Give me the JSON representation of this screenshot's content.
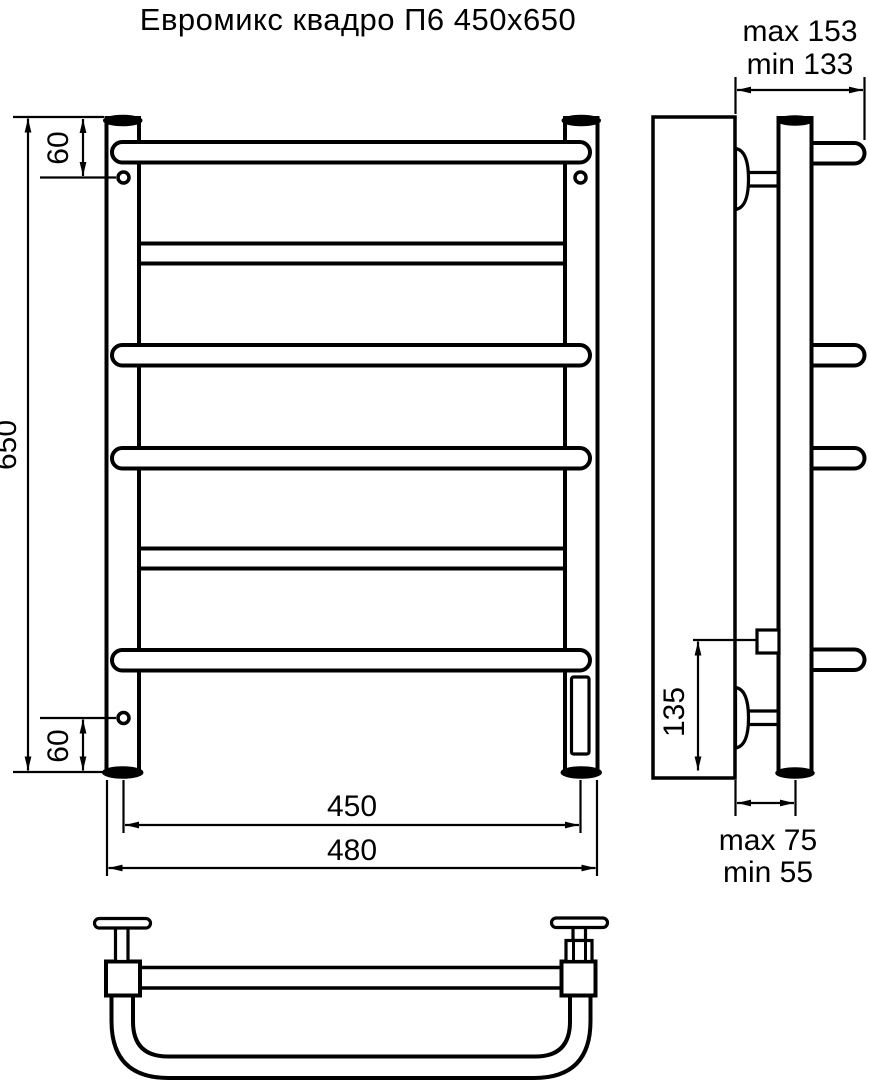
{
  "title": "Евромикс квадро П6 450x650",
  "colors": {
    "line": "#000000",
    "wall_fill": "#eaeaea",
    "background": "#ffffff"
  },
  "front_view": {
    "dim_height": "650",
    "dim_top_hole_offset": "60",
    "dim_bottom_hole_offset": "60",
    "dim_mount_width": "450",
    "dim_overall_width": "480"
  },
  "side_view": {
    "dim_depth_max": "max 153",
    "dim_depth_min": "min 133",
    "dim_power_entry_height": "135",
    "dim_wall_gap_max": "max 75",
    "dim_wall_gap_min": "min 55"
  }
}
